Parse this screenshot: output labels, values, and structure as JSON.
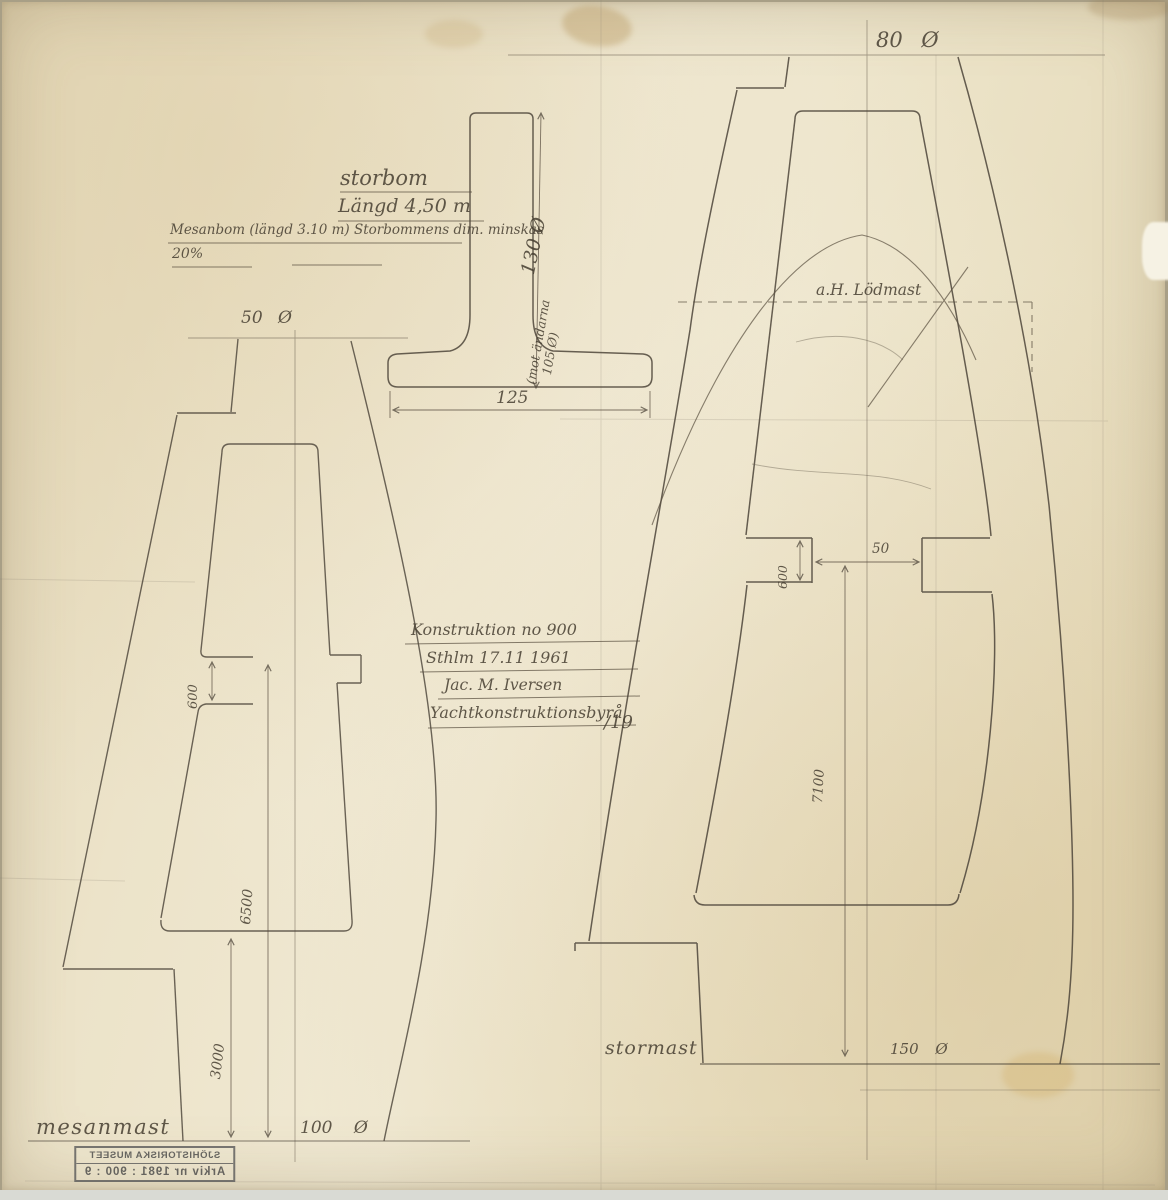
{
  "colors": {
    "paper": "#ece3c9",
    "pencil": "#4a4236",
    "stamp_ink": "#474747"
  },
  "boom": {
    "title": "storbom",
    "length": "Längd 4,50 m",
    "note_line1": "Mesanbom (längd 3.10 m) Storbommens dim. minskas",
    "note_line2": "20%",
    "height_dim": "130 Ø",
    "height_note_l1": "(mot ändarna",
    "height_note_l2": "105 Ø)",
    "width_dim": "125"
  },
  "info_block": {
    "line1": "Konstruktion no 900",
    "line2": "Sthlm 17.11 1961",
    "line3": "Jac. M. Iversen",
    "line4": "Yachtkonstruktionsbyrå",
    "line4_suffix": "/19"
  },
  "mesanmast": {
    "label": "mesanmast",
    "top_diameter": "50 Ø",
    "gooseneck_gap": "600",
    "upper_length": "6500",
    "lower_length": "3000",
    "base_diameter": "100 Ø"
  },
  "stormast": {
    "label": "stormast",
    "top_diameter": "80 Ø",
    "lodmast_note": "a.H. Lödmast",
    "gooseneck_gap": "600",
    "gooseneck_offset": "50",
    "length": "7100",
    "base_diameter": "150 Ø"
  },
  "stamp": {
    "line1": "SJÖHISTORISKA MUSEET",
    "line2": "Arkiv nr 1981 : 900 : 9"
  }
}
